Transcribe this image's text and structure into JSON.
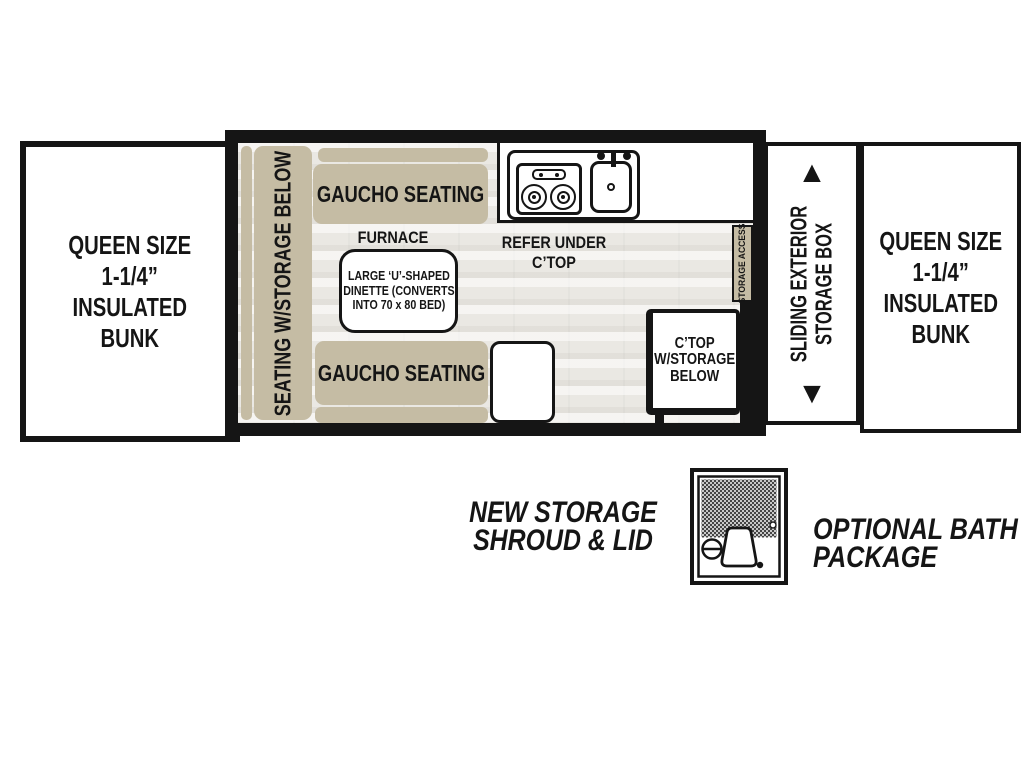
{
  "colors": {
    "tan": "#c5bca4",
    "line": "#151515",
    "floor_base": "#eae8e3",
    "white": "#ffffff"
  },
  "icons": {
    "up_arrow": "▲",
    "down_arrow": "▼",
    "stove": "two-burner-stove",
    "sink": "sink-basin-with-faucet",
    "bath": "shower-toilet-sink"
  },
  "floorplan": {
    "left_bunk": {
      "lines": [
        "QUEEN SIZE",
        "1-1/4”",
        "INSULATED",
        "BUNK"
      ]
    },
    "right_bunk": {
      "lines": [
        "QUEEN SIZE",
        "1-1/4”",
        "INSULATED",
        "BUNK"
      ]
    },
    "slide_panel": {
      "line1": "SLIDING EXTERIOR",
      "line2": "STORAGE BOX"
    },
    "cabin": {
      "side_seating": "SEATING W/STORAGE BELOW",
      "gaucho_top": "GAUCHO SEATING",
      "gaucho_bottom": "GAUCHO SEATING",
      "furnace": "FURNACE",
      "refer": {
        "line1": "REFER UNDER",
        "line2": "C’TOP"
      },
      "dinette": {
        "lines": [
          "LARGE ‘U’-SHAPED",
          "DINETTE (CONVERTS",
          "INTO 70 x 80 BED)"
        ]
      },
      "storage_access": "STORAGE ACCESS",
      "ctop": {
        "lines": [
          "C’TOP",
          "W/STORAGE",
          "BELOW"
        ]
      }
    }
  },
  "callouts": {
    "storage_shroud": {
      "line1": "NEW STORAGE",
      "line2": "SHROUD & LID"
    },
    "bath_package": {
      "line1": "OPTIONAL BATH",
      "line2": "PACKAGE"
    }
  }
}
